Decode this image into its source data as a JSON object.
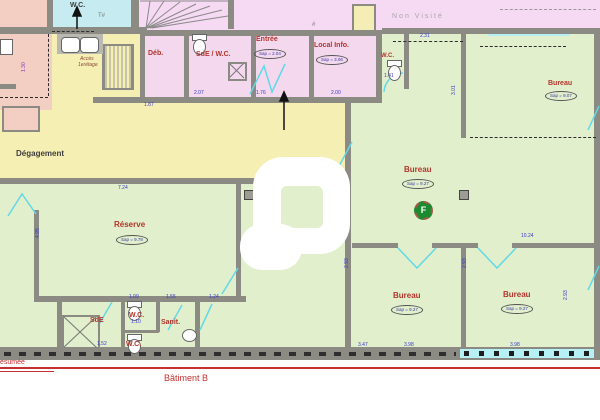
{
  "colors": {
    "wall": "#8b8b83",
    "yellow_zone": "#f6efb4",
    "green_zone": "#e1efcc",
    "pink_rooms": "#f3d8ee",
    "pink_unvisited": "#f6d9f2",
    "salmon_zone": "#f2cfc2",
    "cyan_room": "#c6ecf1",
    "label_red": "#b5342b",
    "dim_blue": "#3838c8",
    "door_cyan": "#62d9e6",
    "line_red": "#c53030",
    "marker_green": "#1c8a2e",
    "unvisited_text": "#a8a8a8"
  },
  "annotations": {
    "non_visite": "Non  Visité",
    "batiment": "Bâtiment B",
    "presumee": "esumée",
    "acces_line1": "Accès",
    "acces_line2": "1erétage",
    "t_mark_1": "T#",
    "t_mark_2": "#",
    "marker_f": "F"
  },
  "rooms": [
    {
      "name": "wc-top-left",
      "label": "W.C.",
      "x": 70,
      "y": 2,
      "cls": "dark",
      "size": 7
    },
    {
      "name": "deb",
      "label": "Déb.",
      "x": 148,
      "y": 50,
      "cls": "red",
      "size": 7
    },
    {
      "name": "sde-wc",
      "label": "SdE / W.C.",
      "x": 196,
      "y": 51,
      "cls": "red",
      "size": 7
    },
    {
      "name": "entree",
      "label": "Entrée",
      "x": 256,
      "y": 36,
      "cls": "red",
      "size": 7,
      "area": "Sap = 2.04",
      "ax": 254,
      "ay": 49
    },
    {
      "name": "local-info",
      "label": "Local Info.",
      "x": 314,
      "y": 42,
      "cls": "red",
      "size": 7,
      "area": "Sap = 3.06",
      "ax": 316,
      "ay": 55
    },
    {
      "name": "wc-top-right",
      "label": "W.C.",
      "x": 381,
      "y": 53,
      "cls": "red",
      "size": 6
    },
    {
      "name": "bureau-ne",
      "label": "Bureau",
      "x": 548,
      "y": 80,
      "cls": "red",
      "size": 7,
      "area": "Sap = 9.07",
      "ax": 545,
      "ay": 91
    },
    {
      "name": "degagement",
      "label": "Dégagement",
      "x": 16,
      "y": 150,
      "cls": "dark",
      "size": 8
    },
    {
      "name": "bureau-center",
      "label": "Bureau",
      "x": 404,
      "y": 166,
      "cls": "red",
      "size": 8,
      "area": "Sap = 9.27",
      "ax": 402,
      "ay": 179
    },
    {
      "name": "reserve",
      "label": "Réserve",
      "x": 114,
      "y": 221,
      "cls": "red",
      "size": 8,
      "area": "Sap = 9.78",
      "ax": 116,
      "ay": 235
    },
    {
      "name": "sde-bottom",
      "label": "SdE",
      "x": 90,
      "y": 317,
      "cls": "red",
      "size": 7
    },
    {
      "name": "wc-bottom-1",
      "label": "W.C.",
      "x": 129,
      "y": 312,
      "cls": "red",
      "size": 7
    },
    {
      "name": "sanit",
      "label": "Sanit.",
      "x": 161,
      "y": 319,
      "cls": "red",
      "size": 7
    },
    {
      "name": "wc-bottom-2",
      "label": "W.C.",
      "x": 126,
      "y": 341,
      "cls": "red",
      "size": 7
    },
    {
      "name": "bureau-sw",
      "label": "Bureau",
      "x": 393,
      "y": 292,
      "cls": "red",
      "size": 8,
      "area": "Sap = 9.27",
      "ax": 391,
      "ay": 305
    },
    {
      "name": "bureau-se",
      "label": "Bureau",
      "x": 503,
      "y": 291,
      "cls": "red",
      "size": 8,
      "area": "Sap = 9.27",
      "ax": 501,
      "ay": 304
    }
  ],
  "dims": [
    {
      "t": "2.31",
      "x": 420,
      "y": 34
    },
    {
      "t": "1.87",
      "x": 144,
      "y": 103
    },
    {
      "t": "2.07",
      "x": 194,
      "y": 91
    },
    {
      "t": "1.76",
      "x": 256,
      "y": 91
    },
    {
      "t": "2.00",
      "x": 331,
      "y": 91
    },
    {
      "t": "1.41",
      "x": 384,
      "y": 74
    },
    {
      "t": "7.24",
      "x": 118,
      "y": 186
    },
    {
      "t": "10.24",
      "x": 521,
      "y": 234
    },
    {
      "t": "1.09",
      "x": 129,
      "y": 295
    },
    {
      "t": "1.55",
      "x": 166,
      "y": 295
    },
    {
      "t": "1.24",
      "x": 209,
      "y": 295
    },
    {
      "t": "1.10",
      "x": 131,
      "y": 320
    },
    {
      "t": "1.52",
      "x": 97,
      "y": 342
    },
    {
      "t": "3.47",
      "x": 358,
      "y": 343
    },
    {
      "t": "3.98",
      "x": 404,
      "y": 343
    },
    {
      "t": "3.98",
      "x": 510,
      "y": 343
    },
    {
      "t": "2.93",
      "x": 345,
      "y": 268,
      "rot": true
    },
    {
      "t": "2.93",
      "x": 463,
      "y": 268,
      "rot": true
    },
    {
      "t": "3.01",
      "x": 452,
      "y": 95,
      "rot": true
    },
    {
      "t": "2.93",
      "x": 564,
      "y": 300,
      "rot": true
    },
    {
      "t": "4.95",
      "x": 36,
      "y": 238,
      "rot": true
    },
    {
      "t": "1.30",
      "x": 22,
      "y": 72,
      "rot": true,
      "purple": true
    }
  ]
}
